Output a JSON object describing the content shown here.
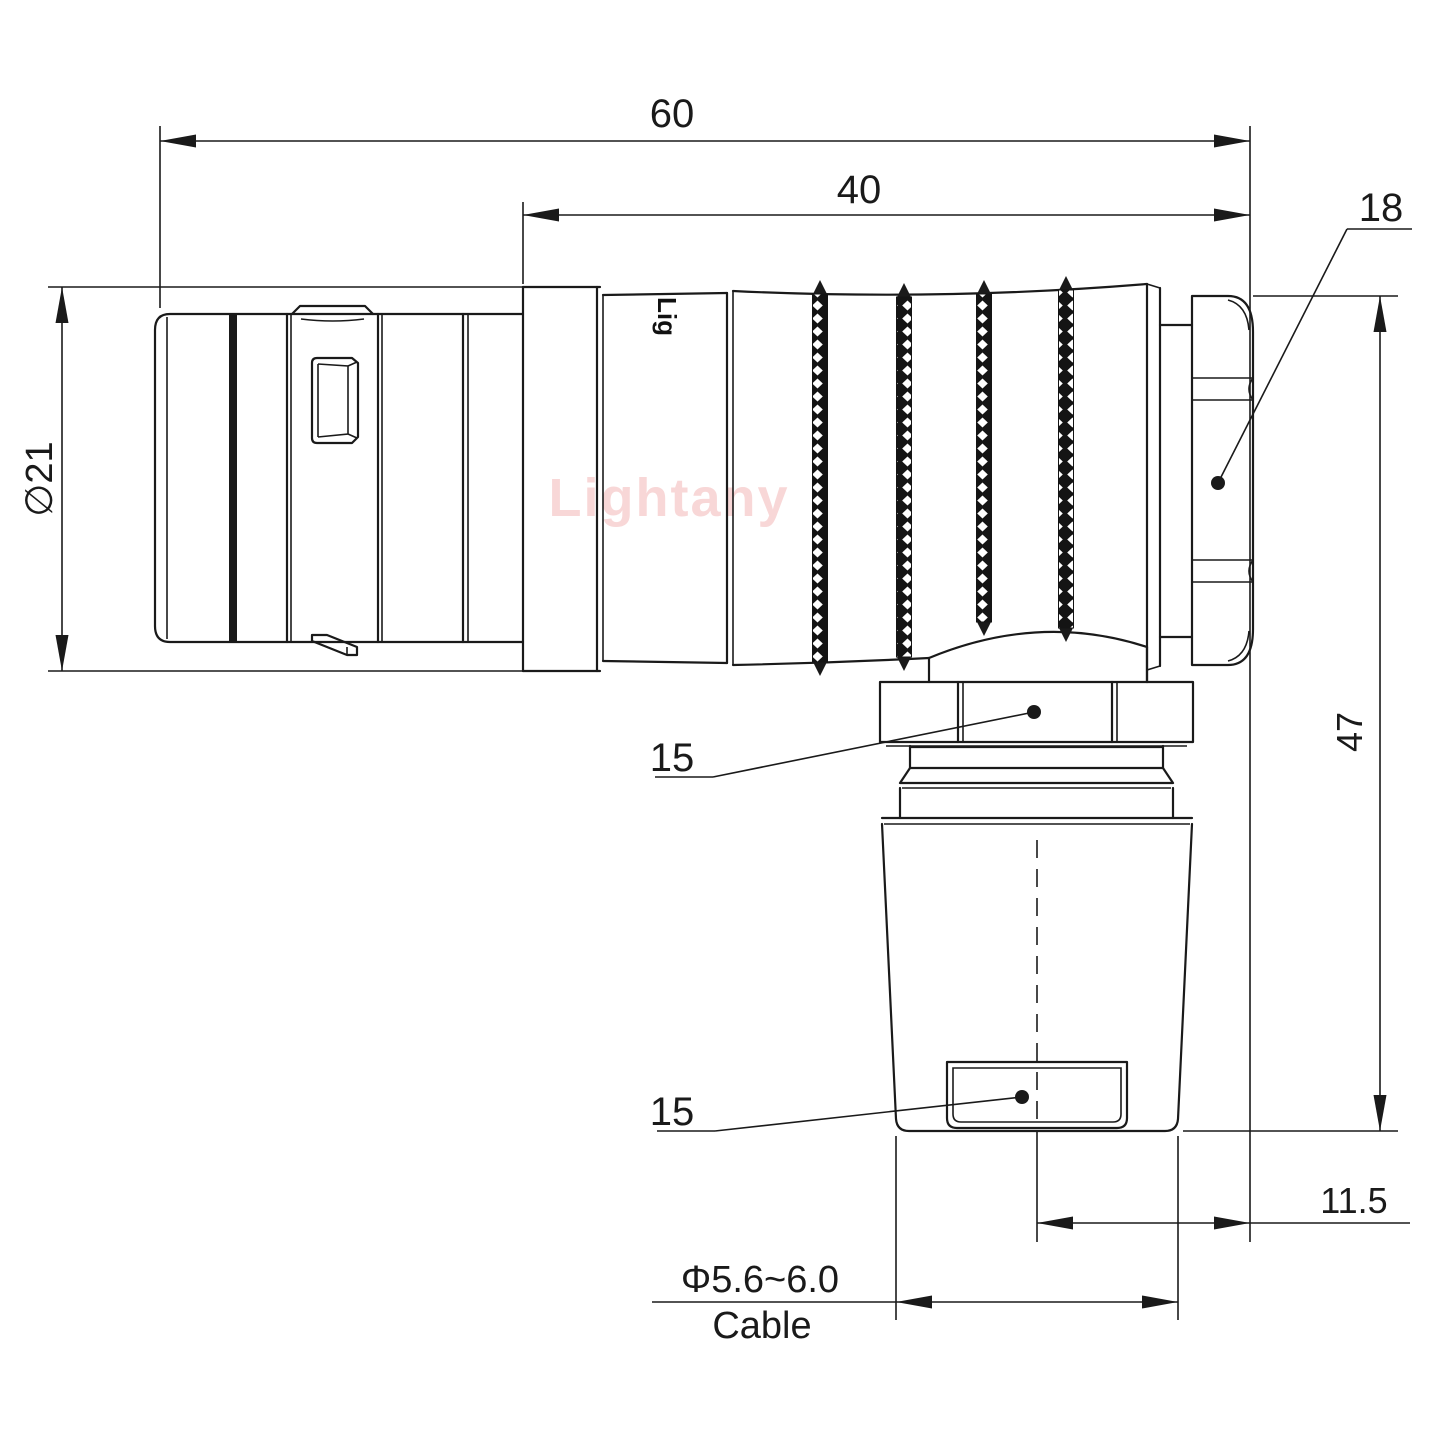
{
  "drawing": {
    "watermark": "Lightany",
    "part_marking": "Lig",
    "dimensions": {
      "overall_length": "60",
      "rear_body_length": "40",
      "panel_nut_ref": "18",
      "overall_height": "47",
      "front_diameter": "∅21",
      "elbow_nut_width": "15",
      "clamp_width": "15",
      "cable_offset": "11.5",
      "cable_diameter_range": "Φ5.6~6.0",
      "cable_label": "Cable"
    },
    "colors": {
      "line": "#1a1a1a",
      "watermark": "#f8d7d7",
      "background": "#ffffff"
    }
  }
}
